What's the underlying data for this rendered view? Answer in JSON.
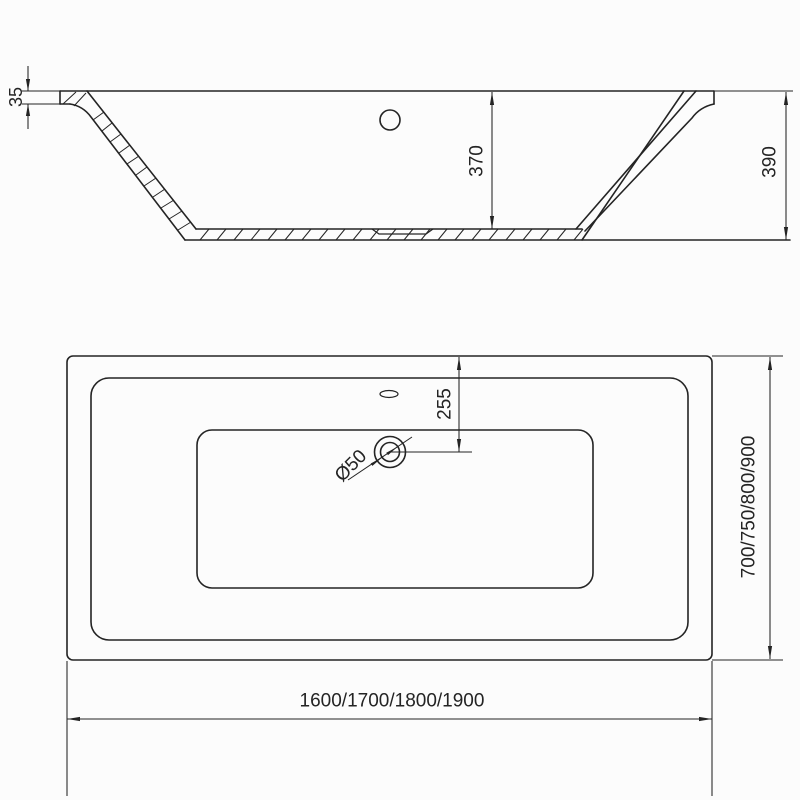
{
  "drawing": {
    "background": "#fcfcfc",
    "line_color": "#242424",
    "side_view": {
      "rim_thickness": "35",
      "inner_depth": "370",
      "total_height": "390"
    },
    "plan_view": {
      "drain_offset": "255",
      "drain_diameter": "Ø50",
      "length_options": "1600/1700/1800/1900",
      "width_options": "700/750/800/900"
    }
  }
}
